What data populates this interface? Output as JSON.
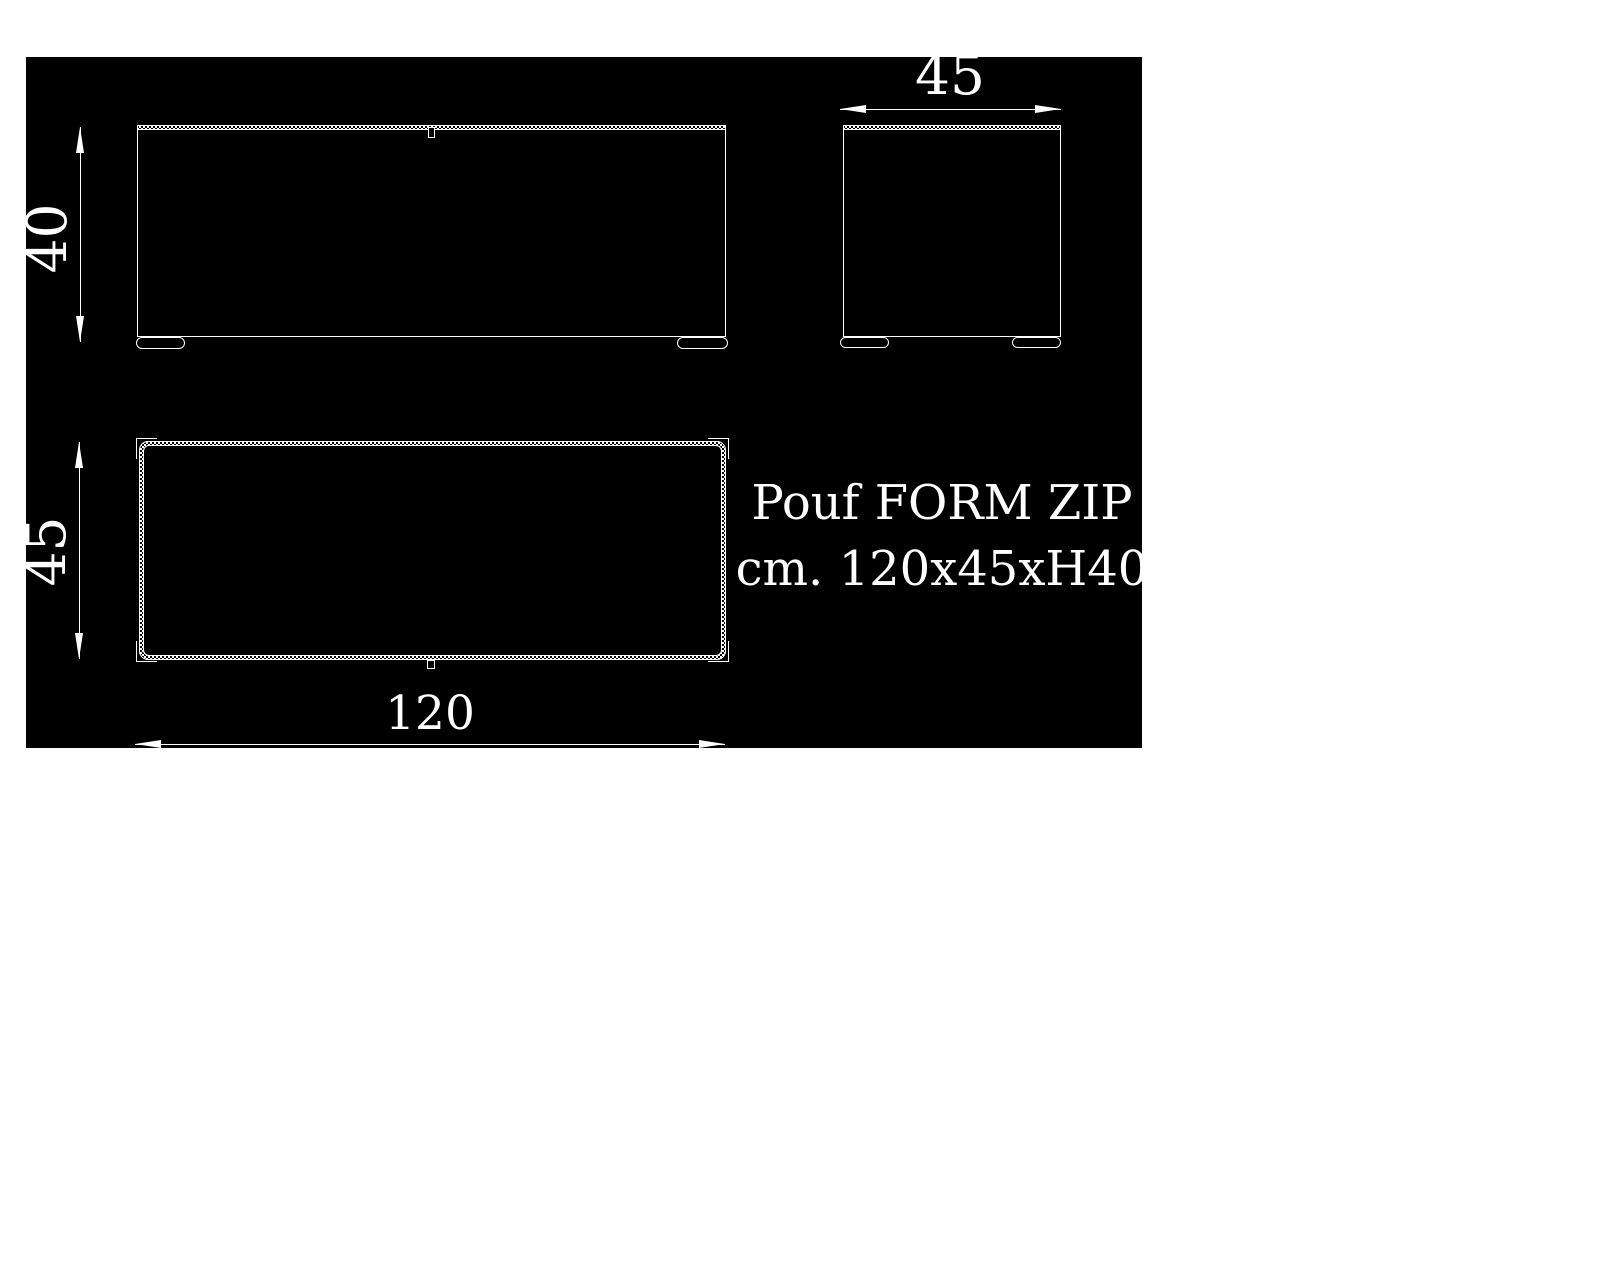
{
  "colors": {
    "page_bg": "#ffffff",
    "drawing_bg": "#000000",
    "line": "#ffffff"
  },
  "product": {
    "name": "Pouf FORM ZIP",
    "size": "cm. 120x45xH40"
  },
  "dimensions": {
    "height": "40",
    "side_width": "45",
    "top_depth": "45",
    "width": "120"
  }
}
